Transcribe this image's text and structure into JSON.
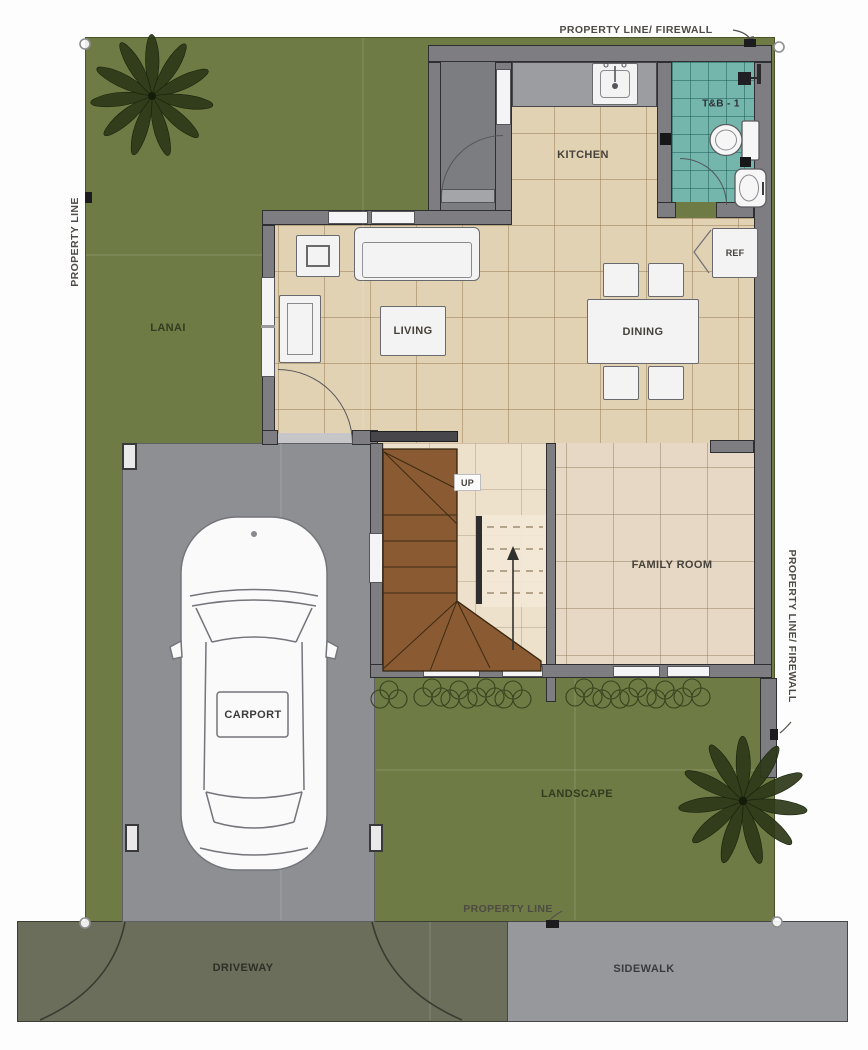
{
  "plan_title": "House ground floor site plan",
  "labels": {
    "property_line_top": "PROPERTY LINE/ FIREWALL",
    "property_line_left": "PROPERTY LINE",
    "property_line_right": "PROPERTY LINE/ FIREWALL",
    "property_line_bottom": "PROPERTY LINE",
    "lanai": "LANAI",
    "kitchen": "KITCHEN",
    "tb1": "T&B - 1",
    "ref": "REF",
    "living": "LIVING",
    "dining": "DINING",
    "up": "UP",
    "family_room": "FAMILY ROOM",
    "carport": "CARPORT",
    "landscape": "LANDSCAPE",
    "driveway": "DRIVEWAY",
    "sidewalk": "SIDEWALK"
  },
  "palette": {
    "lawn": "#6e7b45",
    "floor_main": "#e2d2b4",
    "floor_family": "#e6d8c4",
    "bath_tile": "#74b6ac",
    "stairs": "#8a5a33",
    "carport": "#8e8f92",
    "driveway": "#6b6e5b",
    "sidewalk": "#97989b",
    "wall": "#7e7e82",
    "wall_outline": "#2f2f32",
    "furniture": "#f3f3f4"
  }
}
